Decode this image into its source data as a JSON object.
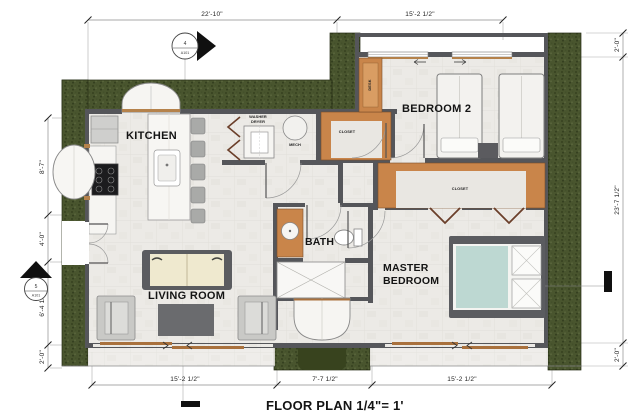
{
  "plan": {
    "title": "FLOOR PLAN 1/4\"= 1'",
    "rooms": {
      "kitchen": "KITCHEN",
      "bedroom2": "BEDROOM 2",
      "bath": "BATH",
      "master1": "MASTER",
      "master2": "BEDROOM",
      "living": "LIVING ROOM"
    },
    "fixtures": {
      "washer": "WASHER",
      "dryer": "DRYER",
      "mech": "MECH",
      "desk": "DESK",
      "closet": "CLOSET"
    },
    "dimensions": {
      "top": [
        "22'-10\"",
        "15'-2 1/2\""
      ],
      "bottom": [
        "15'-2 1/2\"",
        "7'-7 1/2\"",
        "15'-2 1/2\""
      ],
      "left": [
        "8'-7\"",
        "4'-0\"",
        "6'-4 1/2\"",
        "2'-0\""
      ],
      "right": [
        "2'-0\"",
        "23'-7 1/2\"",
        "2'-0\""
      ]
    },
    "markers": {
      "top": {
        "num": "4",
        "sheet": "A101"
      },
      "left": {
        "num": "5",
        "sheet": "A101"
      }
    },
    "colors": {
      "landscape": "#49552e",
      "wall": "#55565a",
      "floor": "#eceae6",
      "wood": "#c4884a",
      "bed_teal": "#bdd8d2",
      "cushion": "#efe9cf"
    }
  }
}
